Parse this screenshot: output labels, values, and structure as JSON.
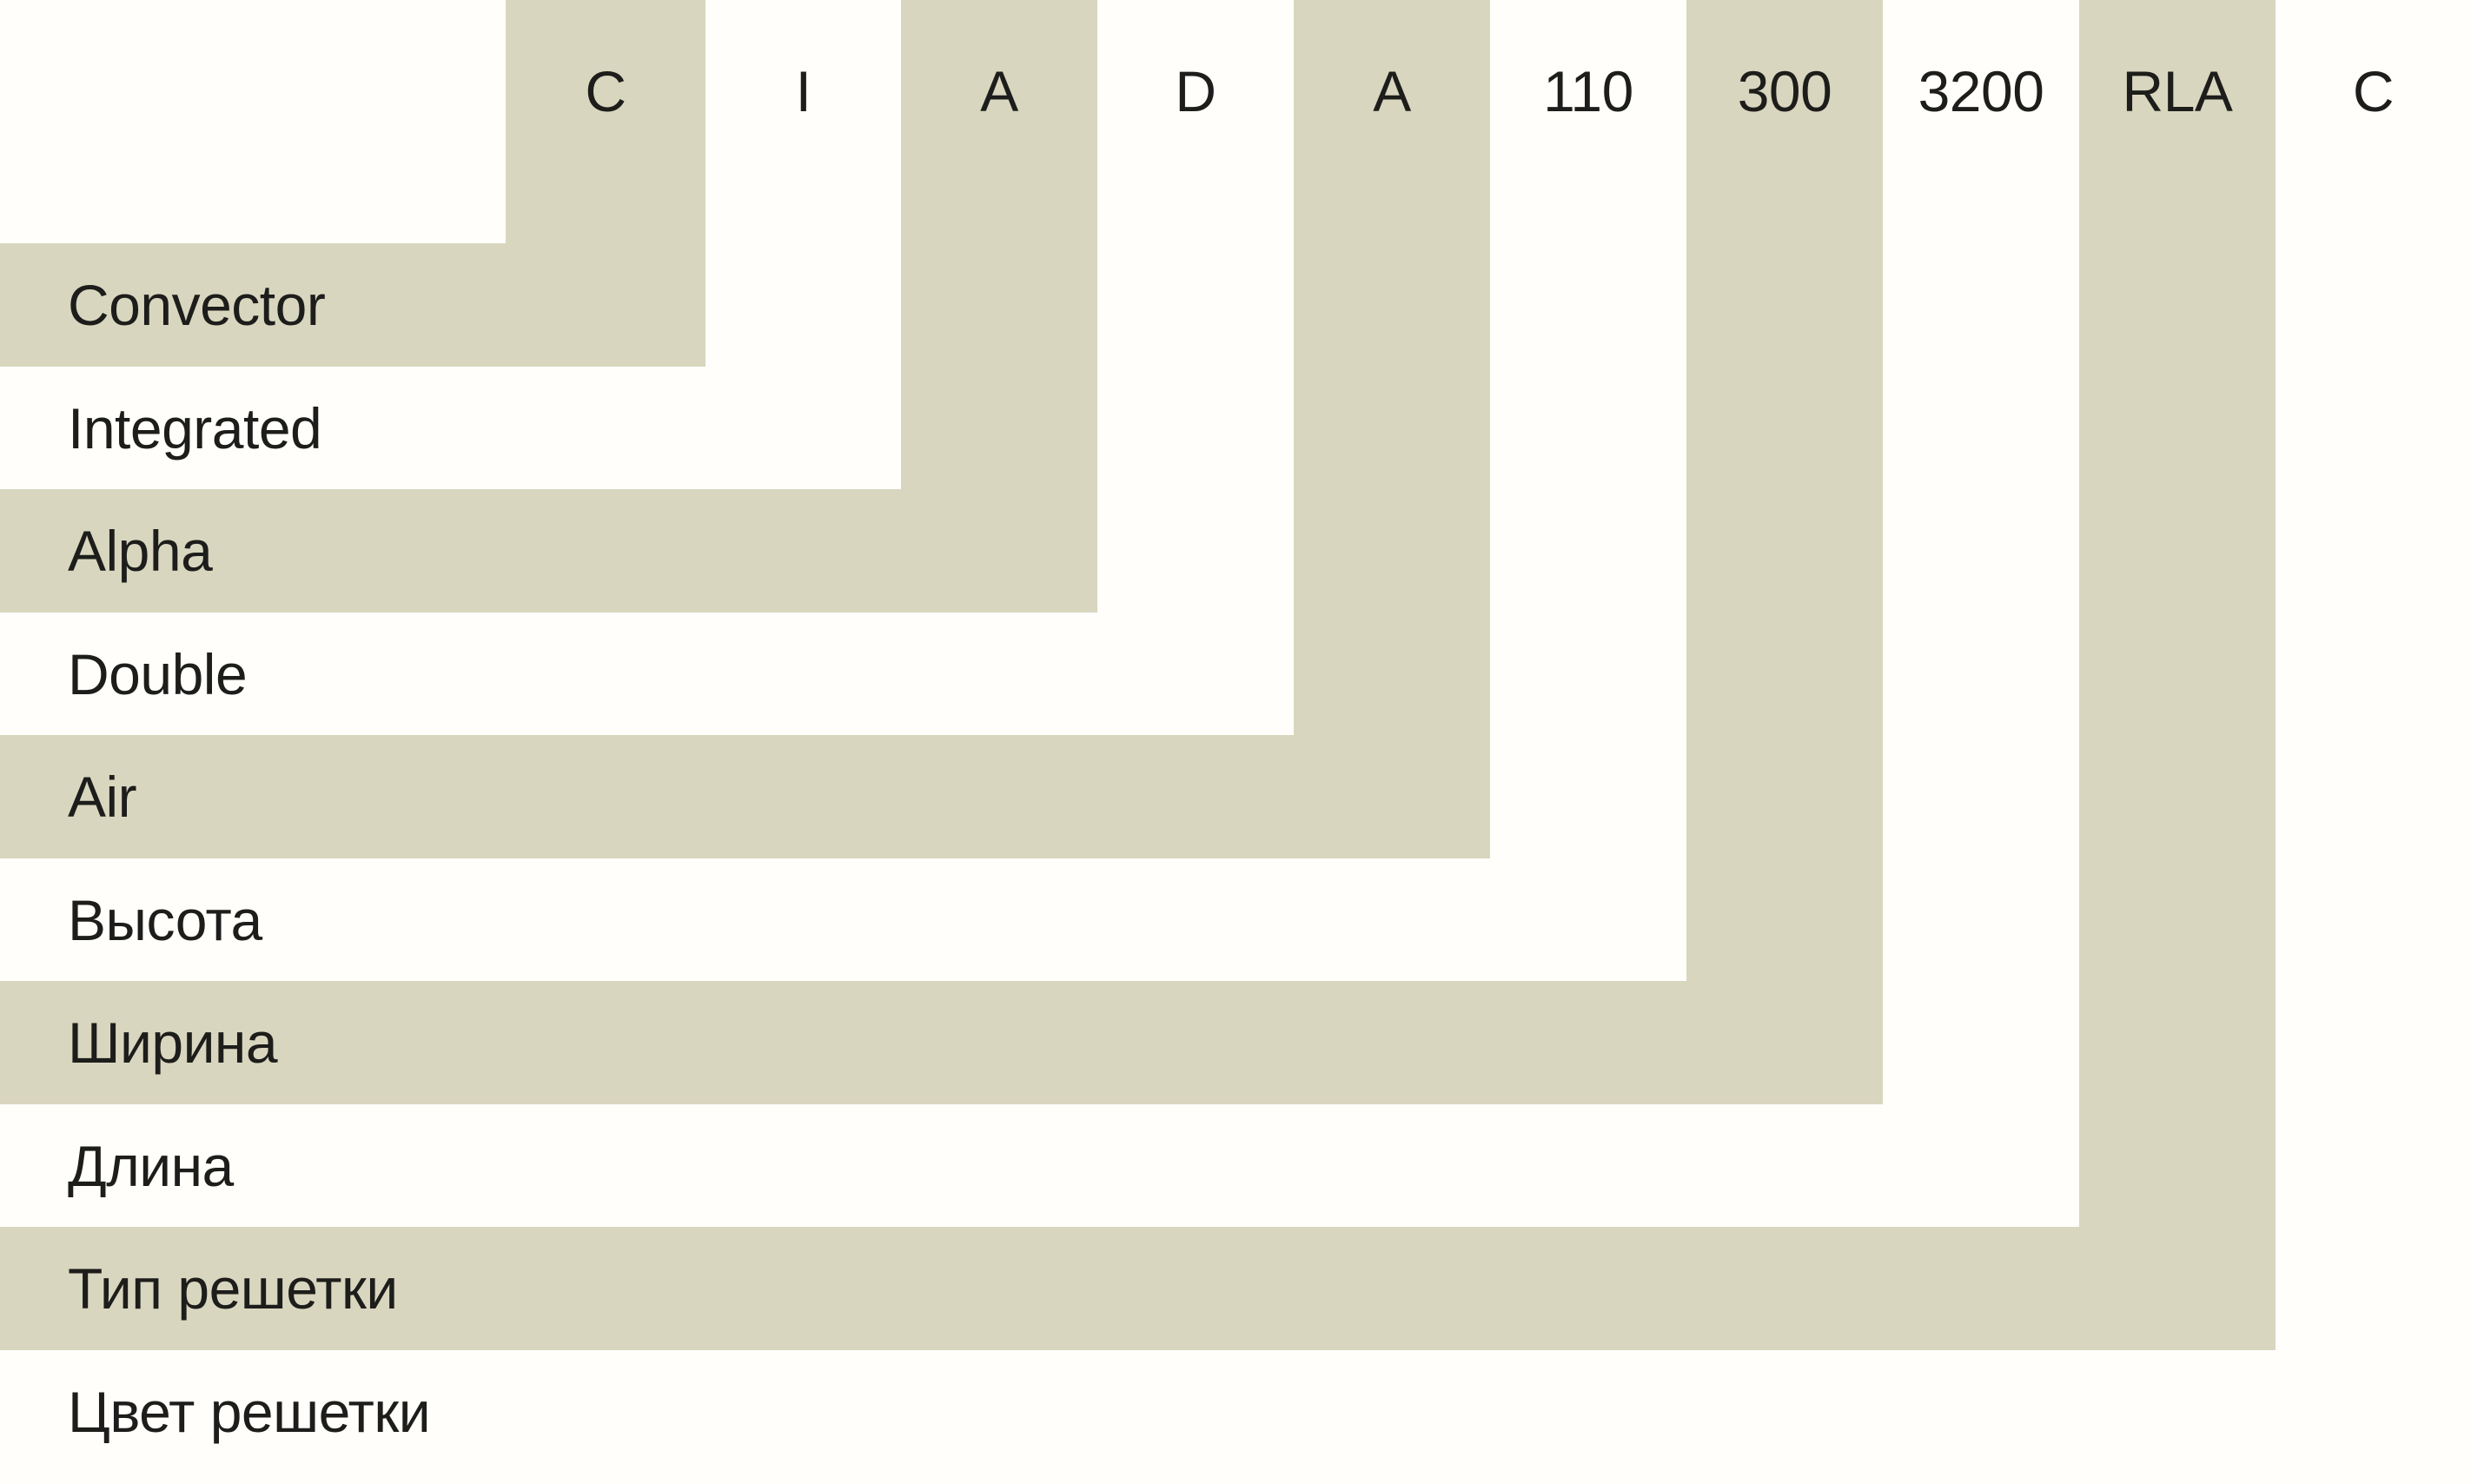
{
  "theme": {
    "shade": "#d9d6bf",
    "bg": "#fffefb",
    "text": "#1d1d1b"
  },
  "nomenclature": {
    "segments": [
      {
        "code": "C",
        "label": "Convector",
        "shaded": true
      },
      {
        "code": "I",
        "label": "Integrated",
        "shaded": false
      },
      {
        "code": "A",
        "label": "Alpha",
        "shaded": true
      },
      {
        "code": "D",
        "label": "Double",
        "shaded": false
      },
      {
        "code": "A",
        "label": "Air",
        "shaded": true
      },
      {
        "code": "110",
        "label": "Высота",
        "shaded": false
      },
      {
        "code": "300",
        "label": "Ширина",
        "shaded": true
      },
      {
        "code": "3200",
        "label": "Длина",
        "shaded": false
      },
      {
        "code": "RLA",
        "label": "Тип решетки",
        "shaded": true
      },
      {
        "code": "C",
        "label": "Цвет решетки",
        "shaded": false
      }
    ]
  }
}
